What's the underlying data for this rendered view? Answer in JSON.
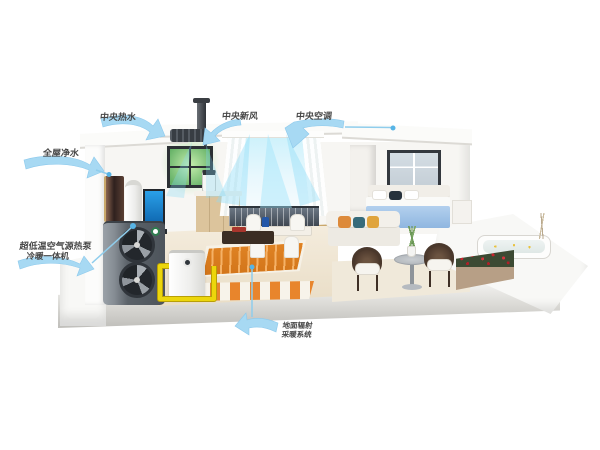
{
  "illustration": {
    "type": "3d-cutaway-house-heat-pump-system",
    "background": "#FFFFFF"
  },
  "labels": {
    "central_hot_water": "中央热水",
    "central_fresh_air": "中央新风",
    "central_air_conditioning": "中央空调",
    "whole_house_water_purification": "全屋净水",
    "heat_pump_line1": "超低温空气源热泵",
    "heat_pump_line2": "冷暖一体机",
    "floor_heating_line1": "地面辐射",
    "floor_heating_line2": "采暖系统"
  },
  "colors": {
    "callout_blue": "#A7D9F3",
    "leader_line_blue": "#8FCDEC",
    "label_text": "#474747",
    "pipe_yellow": "#ECD60B",
    "floor_coil_orange": "#E08324",
    "fresh_air_glow_green": "#8FD08A",
    "window_light_cyan": "#BFEAF8",
    "heat_pump_gray": "#5B6269",
    "bed_blue": "#A9C9EA",
    "flower_red": "#C8242E",
    "aquarium_blue": "#1E7FC4"
  }
}
